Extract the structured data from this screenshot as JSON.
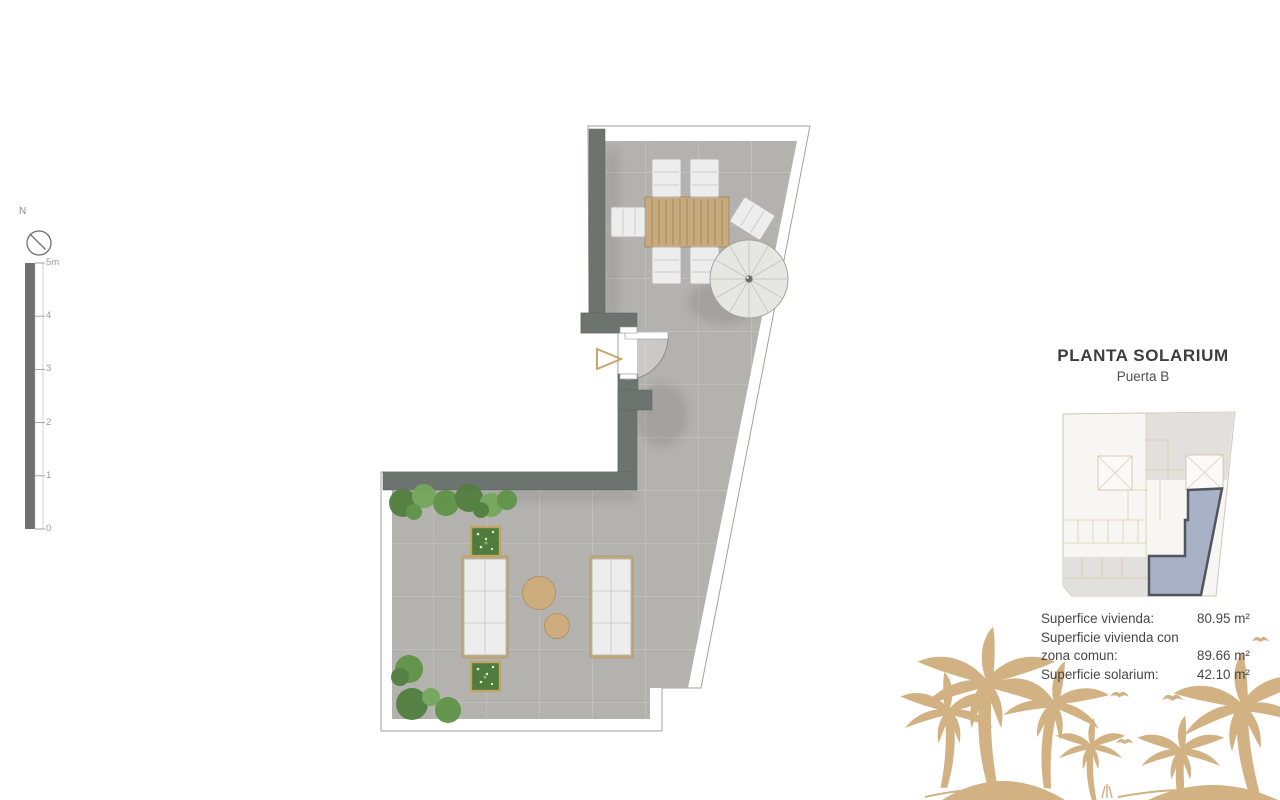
{
  "title_block": {
    "title": "PLANTA SOLARIUM",
    "subtitle": "Puerta B"
  },
  "areas": {
    "rows": [
      {
        "label": "Superfice vivienda:",
        "value": "80.95 m²"
      },
      {
        "label": "Superficie vivienda con",
        "value": ""
      },
      {
        "label": "zona comun:",
        "value": "89.66 m²"
      },
      {
        "label": "Superficie solarium:",
        "value": "42.10 m²"
      }
    ]
  },
  "scale_bar": {
    "unit_labels": [
      "5m",
      "4",
      "3",
      "2",
      "1",
      "0"
    ]
  },
  "compass": {
    "label": "N"
  },
  "colors": {
    "floor": "#b4b2ae",
    "wall": "#6d7470",
    "wood": "#c7aa7d",
    "accent_tan": "#d2b183",
    "plant": "#527f3f",
    "plan_highlight": "#a2aac2",
    "plan_highlight_border": "#4f565e",
    "text_dark": "#3d3d3d",
    "text_mid": "#4f4f4f"
  }
}
